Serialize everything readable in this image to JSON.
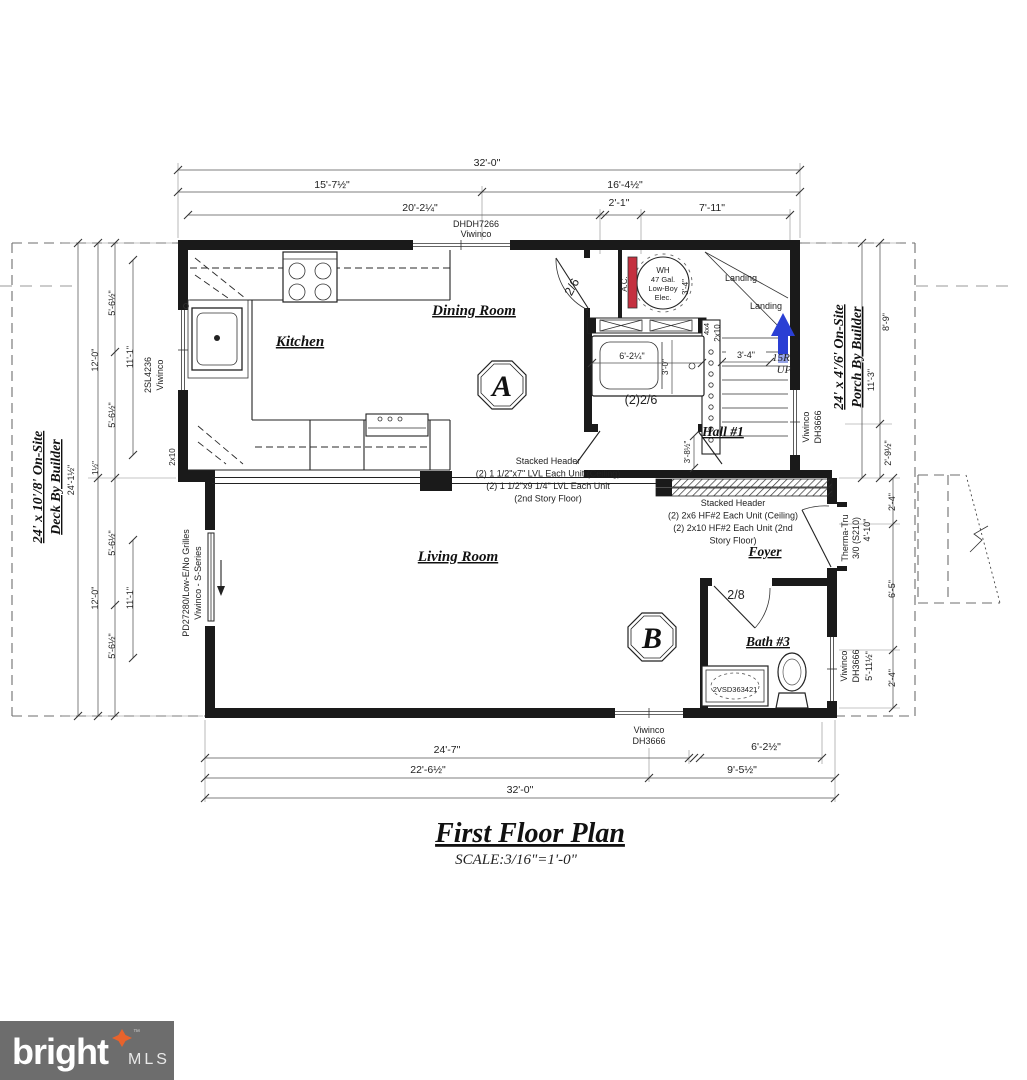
{
  "title": {
    "main": "First Floor Plan",
    "scale": "SCALE:3/16\"=1'-0\""
  },
  "logo": {
    "brand": "bright",
    "suffix": "MLS",
    "tm": "™"
  },
  "top": {
    "d_total": "32'-0\"",
    "d_left": "15'-7½\"",
    "d_right": "16'-4½\"",
    "d_a": "20'-2¼\"",
    "d_b": "2'-1\"",
    "d_c": "7'-11\"",
    "win1": "DHDH7266",
    "win2": "Viwinco"
  },
  "left": {
    "deck1": "24' x 10'/8' On-Site",
    "deck2": "Deck By Builder",
    "total": "24'-1½\"",
    "gap": "1½\"",
    "u12": "12'-0\"",
    "u56a": "5'-6½\"",
    "u111": "11'-1\"",
    "u56b": "5'-6½\"",
    "l56a": "5'-6½\"",
    "l12": "12'-0\"",
    "l111": "11'-1\"",
    "l56b": "5'-6½\"",
    "win1": "2SL4236",
    "win2": "Viwinco",
    "joist": "2x10",
    "pd1": "PD27280/Low-E/No Grilles",
    "pd2": "Viwinco - S-Series"
  },
  "right": {
    "porch1": "24' x 4'/6' On-Site",
    "porch2": "Porch By Builder",
    "d113": "11'-3\"",
    "d89": "8'-9\"",
    "d29": "2'-9½\"",
    "d24a": "2'-4\"",
    "d65": "6'-5\"",
    "d24b": "2'-4\"",
    "stairwin1": "Viwinco",
    "stairwin2": "DH3666",
    "door1": "Therma-Tru",
    "door2": "3/0 (S210)",
    "door_w": "4'-10\"",
    "bathwin1": "Viwinco",
    "bathwin2": "DH3666",
    "bathwin_w": "5'-11½\""
  },
  "rooms": {
    "kitchen": "Kitchen",
    "dining": "Dining Room",
    "living": "Living Room",
    "hall": "Hall #1",
    "foyer": "Foyer",
    "bath3": "Bath #3",
    "marker_a": "A",
    "marker_b": "B"
  },
  "stair": {
    "landing1": "Landing",
    "landing2": "Landing",
    "stringer": "2x10",
    "post": "4x4",
    "width": "3'-4\"",
    "risers": "15R",
    "up": "UP"
  },
  "wh": {
    "l1": "WH",
    "l2": "47 Gal.",
    "l3": "Low-Boy",
    "l4": "Elec.",
    "ac": "A.C.",
    "width": "3'-4\""
  },
  "bath2": {
    "tub_w": "6'-2¼\"",
    "tub_h": "3'-0\"",
    "doors": "(2)2/6",
    "door_upper": "2/6"
  },
  "bath3": {
    "door": "2/8",
    "vanity": "2VSD363421"
  },
  "misc": {
    "hall_h": "3'-8½\""
  },
  "headers": {
    "c1": "Stacked Header",
    "c2": "(2) 1 1/2\"x7\" LVL Each Unit (Ceiling)",
    "c3": "(2) 1 1/2\"x9 1/4\" LVL Each Unit",
    "c4": "(2nd Story Floor)",
    "r1": "Stacked Header",
    "r2": "(2) 2x6 HF#2 Each Unit (Ceiling)",
    "r3": "(2) 2x10 HF#2 Each Unit (2nd",
    "r4": "Story Floor)"
  },
  "bottom": {
    "win1": "Viwinco",
    "win2": "DH3666",
    "d247": "24'-7\"",
    "d62": "6'-2½\"",
    "d226": "22'-6½\"",
    "d95": "9'-5½\"",
    "d32": "32'-0\""
  },
  "colors": {
    "wall": "#1a1a1a",
    "dim": "#555555",
    "red": "#c4303f",
    "blue": "#2a3fd4",
    "blue_light": "#95a3e6",
    "logo_bg": "#6d6d6d",
    "logo_star": "#e8632c"
  }
}
